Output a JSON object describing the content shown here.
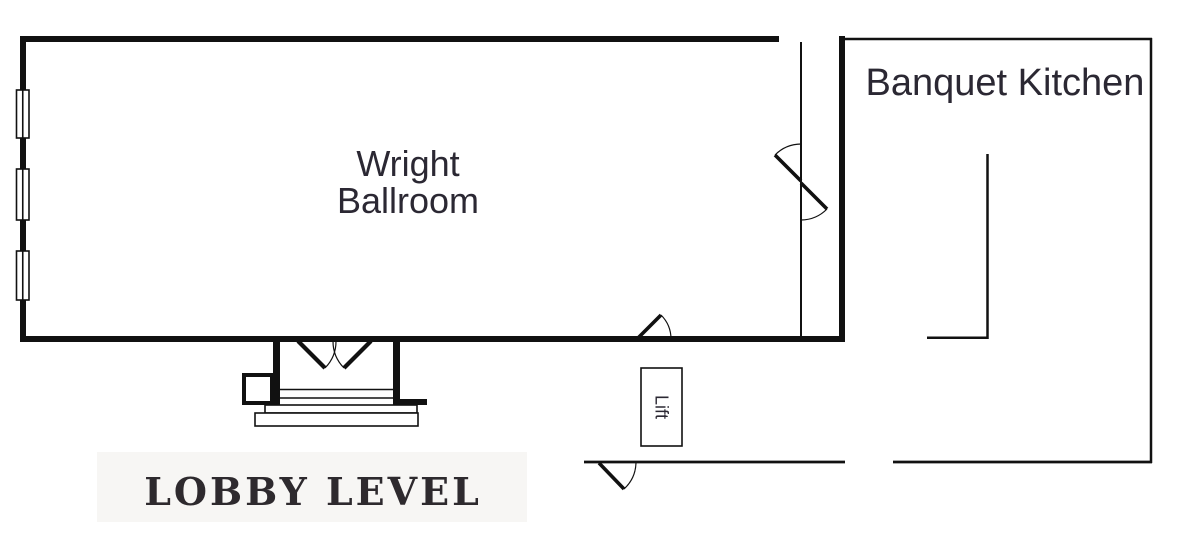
{
  "plan": {
    "level_title": "LOBBY LEVEL",
    "rooms": {
      "ballroom": {
        "name_line1": "Wright",
        "name_line2": "Ballroom"
      },
      "kitchen": {
        "name": "Banquet Kitchen"
      },
      "lift": {
        "name": "Lift"
      }
    }
  },
  "colors": {
    "background": "#ffffff",
    "line": "#111111",
    "room_text": "#2b2833",
    "title_text": "#2e2a2e",
    "title_band": "#f7f6f4"
  }
}
